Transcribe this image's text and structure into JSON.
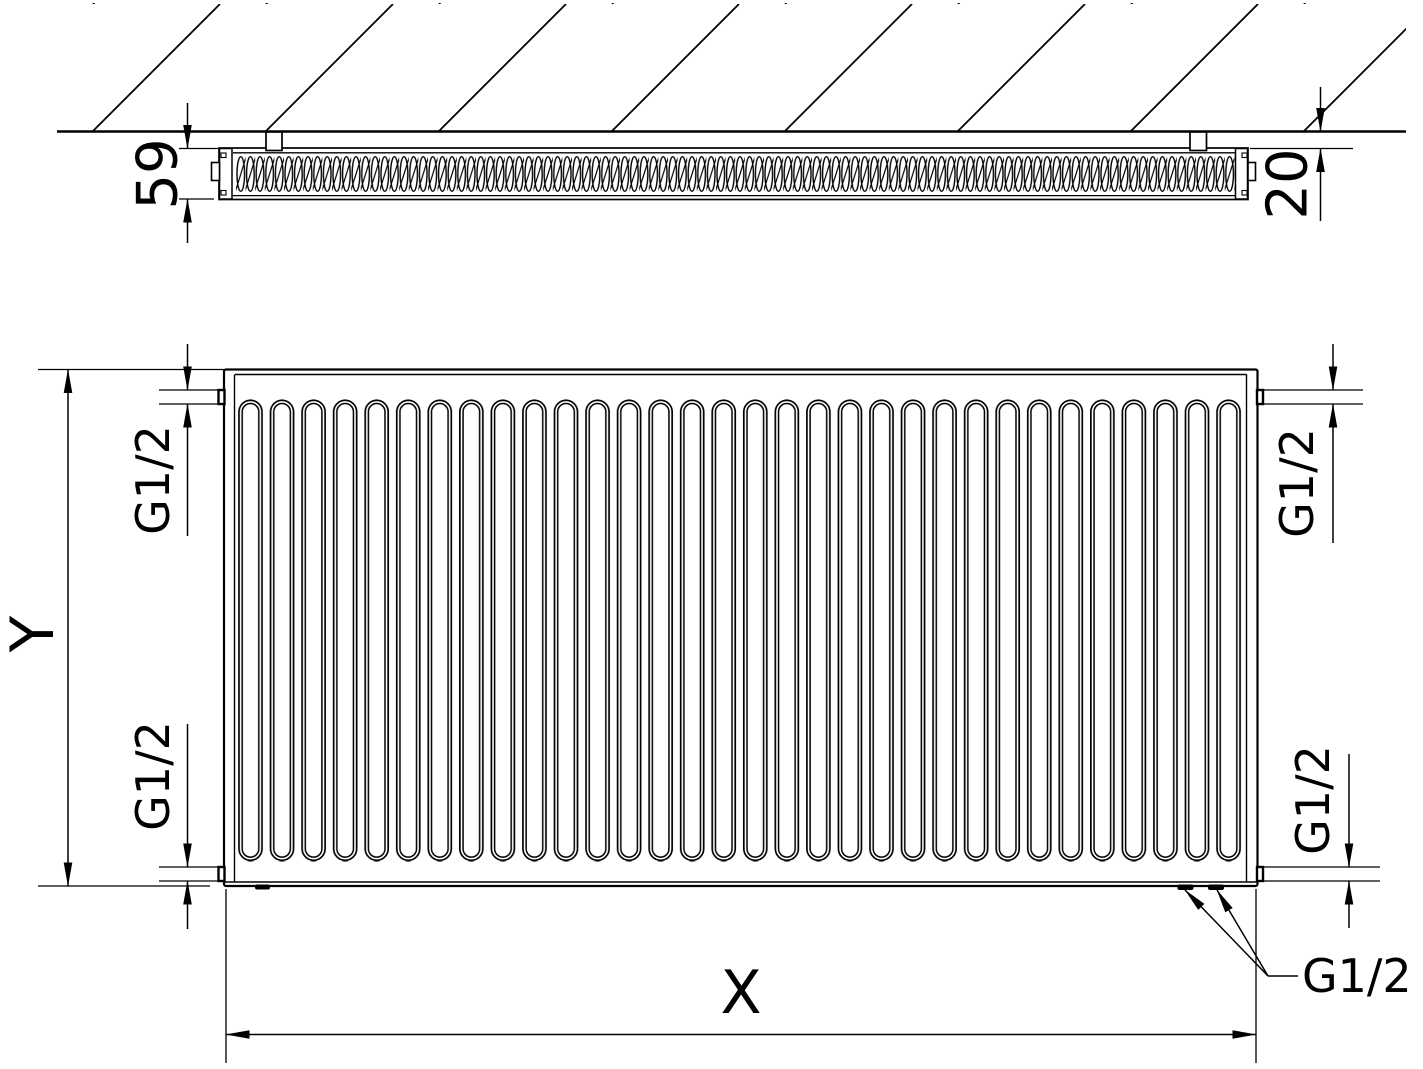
{
  "colors": {
    "line": "#000000",
    "background": "#ffffff"
  },
  "top_view": {
    "depth_label": "59",
    "wall_gap_label": "20"
  },
  "front_view": {
    "height_label": "Y",
    "width_label": "X",
    "thread_top_left": "G1/2",
    "thread_top_right": "G1/2",
    "thread_bottom_left": "G1/2",
    "thread_bottom_right": "G1/2",
    "thread_bottom_ports": "G1/2"
  }
}
